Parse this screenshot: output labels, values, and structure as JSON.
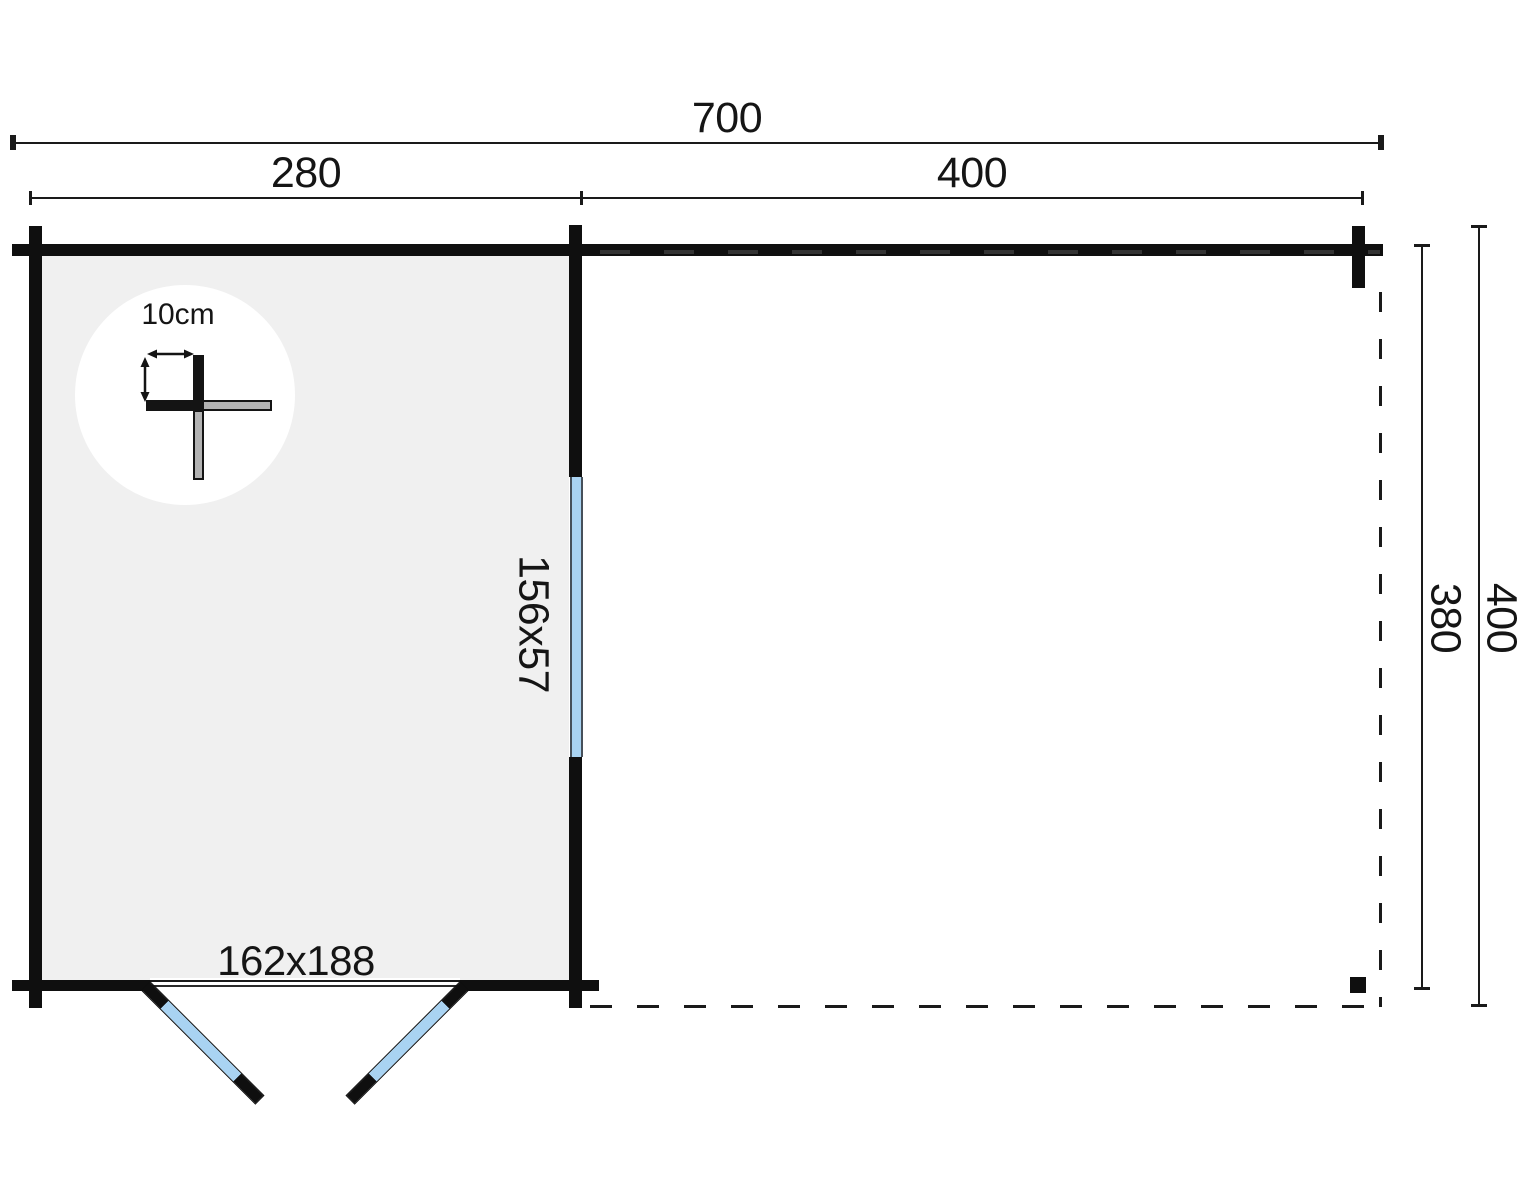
{
  "dimensions": {
    "total_width": "700",
    "cabin_width": "280",
    "canopy_width": "400",
    "canopy_depth_inner": "380",
    "total_depth": "400"
  },
  "wall_detail": {
    "thickness_label": "10cm"
  },
  "window": {
    "size_label": "156x57"
  },
  "door": {
    "size_label": "162x188"
  },
  "colors": {
    "wall": "#0f0f0f",
    "dimension_line": "#1a1a1a",
    "interior_floor": "#f0f0f0",
    "glazing_blue": "#a9d3f2",
    "detail_gray": "#b3b3b3",
    "background": "#ffffff"
  }
}
